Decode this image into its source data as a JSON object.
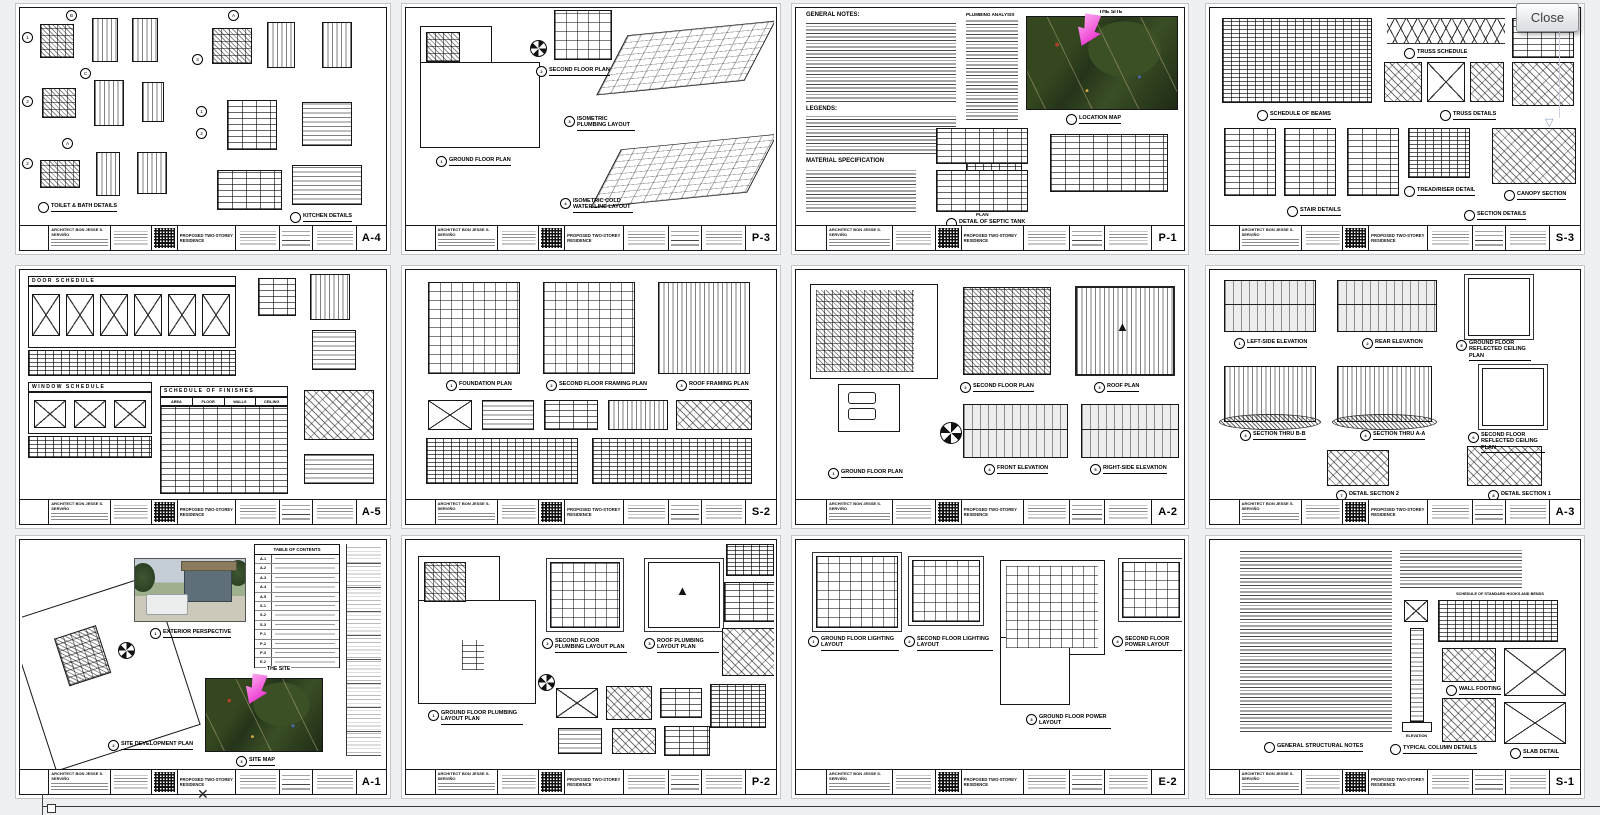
{
  "ui": {
    "close_button": "Close",
    "icons": {
      "scroll_down": "▽",
      "artifact_x": "✕",
      "roof_peak": "▲"
    }
  },
  "title_block": {
    "architect": "ARCHITECT BON JESSE S. SERVIÑO",
    "project": "PROPOSED TWO-STOREY RESIDENCE"
  },
  "colors": {
    "site_arrow": "#ee3fd0",
    "aerial_green": "#2f4020"
  },
  "sheets": {
    "a4": {
      "no": "A-4",
      "bubbles": [
        "1",
        "B",
        "2",
        "C",
        "2",
        "A",
        "3",
        "A",
        "1",
        "2"
      ],
      "caps": {
        "f1": {
          "t": "TOILET & BATH DETAILS"
        },
        "f2": {
          "t": "KITCHEN DETAILS"
        }
      }
    },
    "p3": {
      "no": "P-3",
      "caps": {
        "f1": {
          "n": "1",
          "t": "GROUND FLOOR PLAN"
        },
        "f2": {
          "n": "2",
          "t": "SECOND FLOOR PLAN"
        },
        "f3": {
          "n": "3",
          "t": "ISOMETRIC PLUMBING LAYOUT"
        },
        "f4": {
          "n": "4",
          "t": "ISOMETRIC COLD WATER-LINE LAYOUT"
        }
      }
    },
    "p1": {
      "no": "P-1",
      "headings": {
        "general": "GENERAL NOTES:",
        "legends": "LEGENDS:",
        "material": "MATERIAL SPECIFICATION",
        "plumbing": "PLUMBING ANALYSIS"
      },
      "site_label": "THE SITE",
      "map_caption": "LOCATION MAP",
      "septic": {
        "plan": "PLAN",
        "caption": "DETAIL OF SEPTIC TANK"
      }
    },
    "s3": {
      "no": "S-3",
      "caps": {
        "f1": {
          "t": "SCHEDULE OF BEAMS"
        },
        "f2": {
          "t": "TRUSS SCHEDULE"
        },
        "f3": {
          "t": "TRUSS DETAILS"
        },
        "f4": {
          "t": "STAIR DETAILS"
        },
        "f5": {
          "t": "SECTION DETAILS"
        },
        "f6": {
          "t": "TREAD/RISER DETAIL"
        },
        "f7": {
          "t": "CANOPY SECTION"
        }
      }
    },
    "a5": {
      "no": "A-5",
      "door_schedule": "DOOR SCHEDULE",
      "window_schedule": "WINDOW SCHEDULE",
      "finishes": {
        "title": "SCHEDULE OF FINISHES",
        "columns": [
          "AREA",
          "FLOOR",
          "WALLS",
          "CEILING"
        ]
      }
    },
    "s2": {
      "no": "S-2",
      "caps": {
        "f1": {
          "n": "1",
          "t": "FOUNDATION PLAN"
        },
        "f2": {
          "n": "2",
          "t": "SECOND FLOOR FRAMING PLAN"
        },
        "f3": {
          "n": "3",
          "t": "ROOF FRAMING PLAN"
        }
      }
    },
    "a2": {
      "no": "A-2",
      "caps": {
        "f1": {
          "n": "1",
          "t": "GROUND FLOOR PLAN"
        },
        "f2": {
          "n": "2",
          "t": "SECOND FLOOR PLAN"
        },
        "f3": {
          "n": "3",
          "t": "ROOF PLAN"
        },
        "f4": {
          "n": "4",
          "t": "FRONT ELEVATION"
        },
        "f5": {
          "n": "5",
          "t": "RIGHT-SIDE ELEVATION"
        }
      }
    },
    "a3": {
      "no": "A-3",
      "caps": {
        "f1": {
          "n": "1",
          "t": "LEFT-SIDE ELEVATION"
        },
        "f2": {
          "n": "2",
          "t": "REAR ELEVATION"
        },
        "f3": {
          "n": "5",
          "t": "GROUND FLOOR REFLECTED CEILING PLAN"
        },
        "f4": {
          "n": "3",
          "t": "SECTION THRU B-B"
        },
        "f5": {
          "n": "4",
          "t": "SECTION THRU A-A"
        },
        "f6": {
          "n": "6",
          "t": "SECOND FLOOR REFLECTED CEILING PLAN"
        },
        "f7": {
          "n": "7",
          "t": "DETAIL SECTION 2"
        },
        "f8": {
          "n": "8",
          "t": "DETAIL SECTION 1"
        }
      }
    },
    "a1": {
      "no": "A-1",
      "toc_title": "TABLE OF CONTENTS",
      "toc_codes": [
        "A-1",
        "A-2",
        "A-3",
        "A-4",
        "A-5",
        "S-1",
        "S-2",
        "S-3",
        "P-1",
        "P-2",
        "P-3",
        "E-2"
      ],
      "site_label": "THE SITE",
      "caps": {
        "f1": {
          "n": "1",
          "t": "EXTERIOR PERSPECTIVE"
        },
        "f2": {
          "n": "2",
          "t": "SITE DEVELOPMENT PLAN"
        },
        "f3": {
          "n": "3",
          "t": "SITE MAP"
        }
      }
    },
    "p2": {
      "no": "P-2",
      "caps": {
        "f1": {
          "n": "1",
          "t": "GROUND FLOOR PLUMBING LAYOUT PLAN"
        },
        "f2": {
          "n": "2",
          "t": "SECOND FLOOR PLUMBING LAYOUT PLAN"
        },
        "f3": {
          "n": "3",
          "t": "ROOF PLUMBING LAYOUT PLAN"
        }
      }
    },
    "e2": {
      "no": "E-2",
      "caps": {
        "f1": {
          "n": "1",
          "t": "GROUND FLOOR LIGHTING LAYOUT"
        },
        "f2": {
          "n": "2",
          "t": "SECOND FLOOR LIGHTING LAYOUT"
        },
        "f3": {
          "n": "3",
          "t": "GROUND FLOOR POWER LAYOUT"
        },
        "f4": {
          "n": "4",
          "t": "SECOND FLOOR POWER LAYOUT"
        }
      }
    },
    "s1": {
      "no": "S-1",
      "caps": {
        "f1": {
          "t": "GENERAL STRUCTURAL NOTES"
        },
        "f2": {
          "t": "SCHEDULE OF STANDARD HOOKS AND BENDS"
        },
        "f3": {
          "t": "TYPICAL COLUMN DETAILS"
        },
        "f4": {
          "t": "ELEVATION"
        },
        "f5": {
          "t": "WALL FOOTING"
        },
        "f6": {
          "t": "SLAB DETAIL"
        }
      }
    }
  }
}
